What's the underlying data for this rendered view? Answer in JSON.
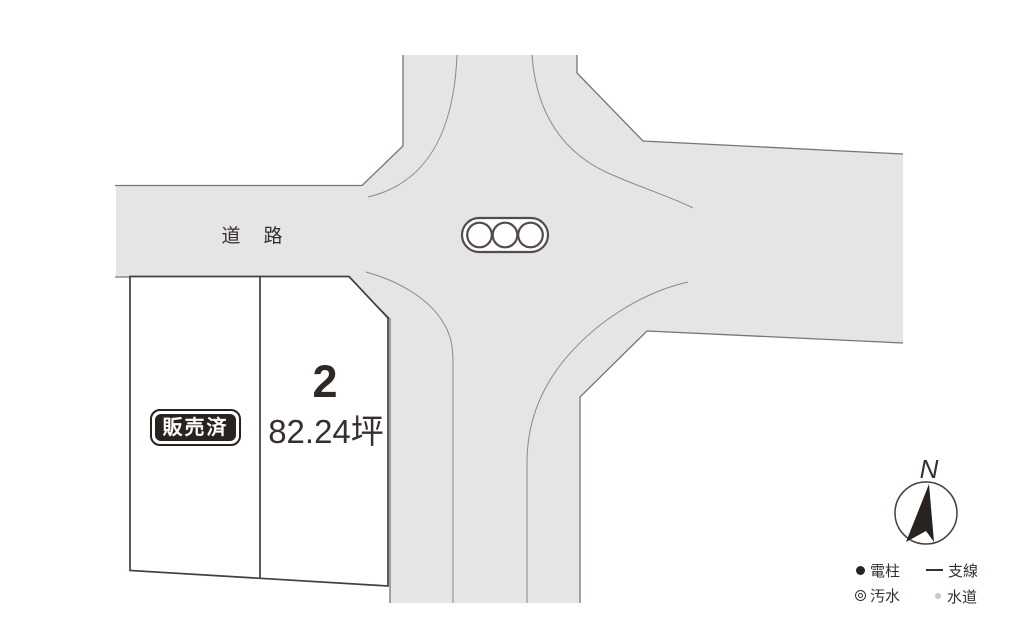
{
  "road": {
    "label": "道　路"
  },
  "plots": [
    {
      "id": "plot-sold",
      "status_label": "販売済"
    },
    {
      "id": "plot-2",
      "number": "2",
      "area_label": "82.24坪"
    }
  ],
  "compass": {
    "north_label": "N"
  },
  "legend": {
    "items": [
      {
        "id": "utility-pole",
        "symbol": "filled-black-circle",
        "label": "電柱"
      },
      {
        "id": "guy-wire",
        "symbol": "horizontal-line",
        "label": "支線"
      },
      {
        "id": "sewage",
        "symbol": "double-circle",
        "label": "汚水"
      },
      {
        "id": "water",
        "symbol": "small-gray-dot",
        "label": "水道"
      }
    ]
  },
  "colors": {
    "road_fill": "#e5e4e6",
    "road_edge": "#7b7470",
    "curb_line": "#8d8784",
    "plot_border": "#453e3a",
    "ink": "#372f2b",
    "badge_background": "#292320",
    "badge_text": "#ffffff",
    "water_dot": "#c9c9c9"
  }
}
